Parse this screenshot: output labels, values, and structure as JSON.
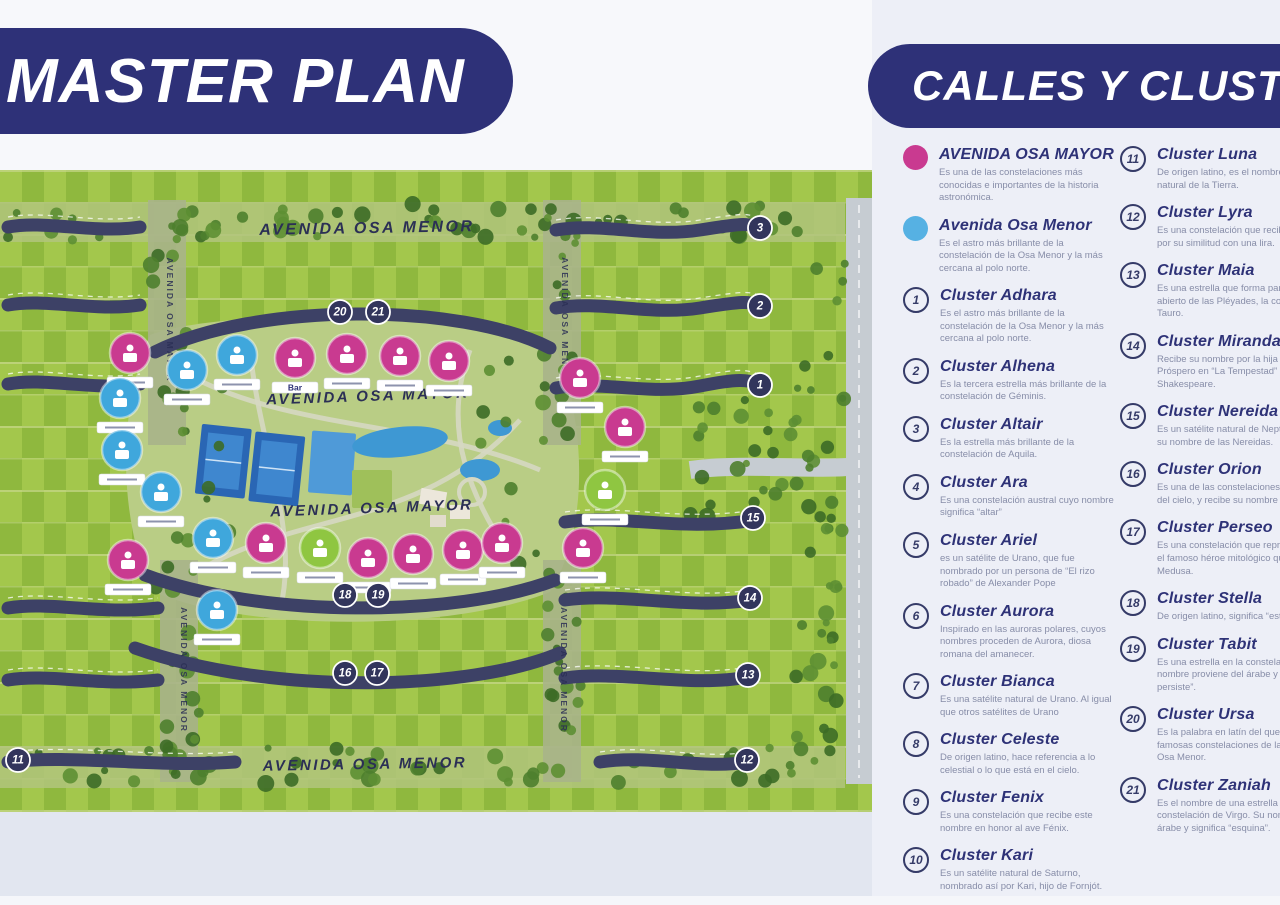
{
  "titles": {
    "master_plan": "MASTER PLAN",
    "calles_clusters": "CALLES Y CLUSTERS"
  },
  "colors": {
    "navy": "#2e3178",
    "pink": "#c93a90",
    "blue": "#56b1e3",
    "green": "#8fc641",
    "road": "#3d4166",
    "field_light": "#a3c74c",
    "field_dark": "#8fb83e"
  },
  "legend": {
    "avenidas": [
      {
        "name": "AVENIDA OSA MAYOR",
        "color": "#c93a90",
        "desc": "Es una de las constelaciones más conocidas e importantes de la historia astronómica."
      },
      {
        "name": "Avenida Osa Menor",
        "color": "#56b1e3",
        "desc": "Es el astro más brillante de la constelación de la Osa Menor y la más cercana al polo norte."
      }
    ],
    "clusters": [
      {
        "num": "1",
        "name": "Cluster Adhara",
        "desc": "Es el astro más brillante de la constelación de la Osa Menor y la más cercana al polo norte."
      },
      {
        "num": "2",
        "name": "Cluster Alhena",
        "desc": "Es la tercera estrella más brillante de la constelación de Géminis."
      },
      {
        "num": "3",
        "name": "Cluster Altair",
        "desc": "Es la estrella más brillante de la constelación de Aquila."
      },
      {
        "num": "4",
        "name": "Cluster Ara",
        "desc": "Es una constelación austral cuyo nombre significa “altar”"
      },
      {
        "num": "5",
        "name": "Cluster Ariel",
        "desc": "es un satélite de Urano, que fue nombrado por un persona de “El rizo robado” de Alexander Pope"
      },
      {
        "num": "6",
        "name": "Cluster Aurora",
        "desc": "Inspirado en las auroras polares, cuyos nombres proceden de Aurora, diosa romana del amanecer."
      },
      {
        "num": "7",
        "name": "Cluster Bianca",
        "desc": "Es una satélite natural de Urano. Al igual que otros satélites de Urano"
      },
      {
        "num": "8",
        "name": "Cluster Celeste",
        "desc": "De origen latino, hace referencia a lo celestial o lo que está en el cielo."
      },
      {
        "num": "9",
        "name": "Cluster Fenix",
        "desc": "Es una constelación que recibe este nombre en honor al ave Fénix."
      },
      {
        "num": "10",
        "name": "Cluster Kari",
        "desc": "Es un satélite natural de Saturno, nombrado así por Kari, hijo de Fornjót."
      },
      {
        "num": "11",
        "name": "Cluster Luna",
        "desc": "De origen latino, es el nombre del satélite natural de la Tierra."
      },
      {
        "num": "12",
        "name": "Cluster Lyra",
        "desc": "Es una constelación que recibe este nombre por su similitud con una lira."
      },
      {
        "num": "13",
        "name": "Cluster Maia",
        "desc": "Es una estrella que forma parte del cúmulo abierto de las Pléyades, la constelación de Tauro."
      },
      {
        "num": "14",
        "name": "Cluster Miranda",
        "desc": "Recibe su nombre por la hija del mago Próspero en “La Tempestad” de William Shakespeare."
      },
      {
        "num": "15",
        "name": "Cluster Nereida",
        "desc": "Es un satélite natural de Neptuno que recibe su nombre de las Nereidas."
      },
      {
        "num": "16",
        "name": "Cluster Orion",
        "desc": "Es una de las constelaciones más conocidas del cielo, y recibe su nombre por Orión."
      },
      {
        "num": "17",
        "name": "Cluster Perseo",
        "desc": "Es una constelación que representa a Perseo, el famoso héroe mitológico que decapitó a Medusa."
      },
      {
        "num": "18",
        "name": "Cluster Stella",
        "desc": "De origen latino, significa “estrella”."
      },
      {
        "num": "19",
        "name": "Cluster Tabit",
        "desc": "Es una estrella en la constelación de Orión. Su nombre proviene del árabe y significa “la que persiste”."
      },
      {
        "num": "20",
        "name": "Cluster Ursa",
        "desc": "Es la palabra en latín del que proviene de las famosas constelaciones de la Osa Mayor y la Osa Menor."
      },
      {
        "num": "21",
        "name": "Cluster Zaniah",
        "desc": "Es el nombre de una estrella en la constelación de Virgo. Su nombre es de origen árabe y significa “esquina”."
      }
    ]
  },
  "map": {
    "street_labels": [
      {
        "text": "AVENIDA OSA MENOR",
        "x": 367,
        "y": 63,
        "size": 16,
        "rot": -1
      },
      {
        "text": "AVENIDA OSA MAYOR",
        "x": 368,
        "y": 231,
        "size": 15,
        "rot": -2
      },
      {
        "text": "AVENIDA OSA MAYOR",
        "x": 372,
        "y": 343,
        "size": 15,
        "rot": -2
      },
      {
        "text": "AVENIDA OSA MENOR",
        "x": 365,
        "y": 599,
        "size": 15,
        "rot": -1
      }
    ],
    "vertical_labels": [
      {
        "text": "AVENIDA OSA MAYOR",
        "x": 167,
        "y": 150
      },
      {
        "text": "AVENIDA OSA MENOR",
        "x": 562,
        "y": 150
      },
      {
        "text": "AVENIDA OSA MENOR",
        "x": 181,
        "y": 500
      },
      {
        "text": "AVENIDA OSA MENOR",
        "x": 561,
        "y": 500
      }
    ],
    "badges": [
      {
        "n": "20",
        "x": 340,
        "y": 142
      },
      {
        "n": "21",
        "x": 378,
        "y": 142
      },
      {
        "n": "3",
        "x": 760,
        "y": 58
      },
      {
        "n": "2",
        "x": 760,
        "y": 136
      },
      {
        "n": "1",
        "x": 760,
        "y": 215
      },
      {
        "n": "15",
        "x": 753,
        "y": 348
      },
      {
        "n": "14",
        "x": 750,
        "y": 428
      },
      {
        "n": "13",
        "x": 748,
        "y": 505
      },
      {
        "n": "12",
        "x": 747,
        "y": 590
      },
      {
        "n": "11",
        "x": 18,
        "y": 590
      },
      {
        "n": "18",
        "x": 345,
        "y": 425
      },
      {
        "n": "19",
        "x": 378,
        "y": 425
      },
      {
        "n": "16",
        "x": 345,
        "y": 503
      },
      {
        "n": "17",
        "x": 377,
        "y": 503
      }
    ],
    "markers": [
      {
        "x": 130,
        "y": 183,
        "c": "#c93a90",
        "label": ""
      },
      {
        "x": 187,
        "y": 200,
        "c": "#3fa7dc",
        "label": ""
      },
      {
        "x": 237,
        "y": 185,
        "c": "#3fa7dc",
        "label": ""
      },
      {
        "x": 295,
        "y": 188,
        "c": "#c93a90",
        "label": "Bar"
      },
      {
        "x": 347,
        "y": 184,
        "c": "#c93a90",
        "label": ""
      },
      {
        "x": 400,
        "y": 186,
        "c": "#c93a90",
        "label": ""
      },
      {
        "x": 449,
        "y": 191,
        "c": "#c93a90",
        "label": ""
      },
      {
        "x": 120,
        "y": 228,
        "c": "#3fa7dc",
        "label": ""
      },
      {
        "x": 122,
        "y": 280,
        "c": "#3fa7dc",
        "label": ""
      },
      {
        "x": 161,
        "y": 322,
        "c": "#3fa7dc",
        "label": ""
      },
      {
        "x": 580,
        "y": 208,
        "c": "#c93a90",
        "label": ""
      },
      {
        "x": 625,
        "y": 257,
        "c": "#c93a90",
        "label": ""
      },
      {
        "x": 605,
        "y": 320,
        "c": "#8fc641",
        "label": ""
      },
      {
        "x": 583,
        "y": 378,
        "c": "#c93a90",
        "label": ""
      },
      {
        "x": 128,
        "y": 390,
        "c": "#c93a90",
        "label": ""
      },
      {
        "x": 213,
        "y": 368,
        "c": "#3fa7dc",
        "label": ""
      },
      {
        "x": 266,
        "y": 373,
        "c": "#c93a90",
        "label": ""
      },
      {
        "x": 320,
        "y": 378,
        "c": "#8fc641",
        "label": ""
      },
      {
        "x": 368,
        "y": 388,
        "c": "#c93a90",
        "label": ""
      },
      {
        "x": 413,
        "y": 384,
        "c": "#c93a90",
        "label": ""
      },
      {
        "x": 463,
        "y": 380,
        "c": "#c93a90",
        "label": ""
      },
      {
        "x": 502,
        "y": 373,
        "c": "#c93a90",
        "label": ""
      },
      {
        "x": 217,
        "y": 440,
        "c": "#3fa7dc",
        "label": ""
      }
    ]
  }
}
